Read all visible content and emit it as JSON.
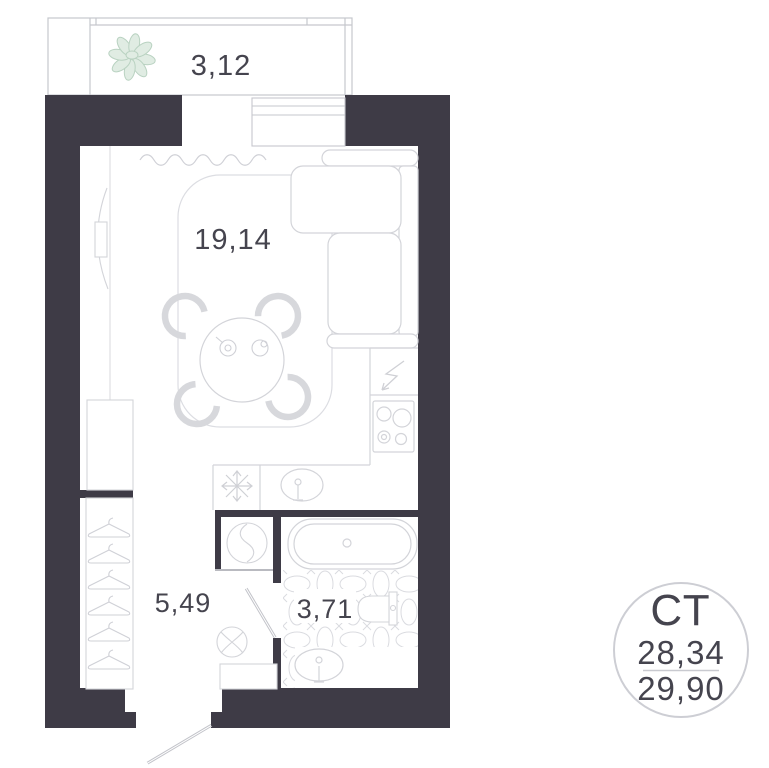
{
  "plan": {
    "areas": {
      "balcony": "3,12",
      "living": "19,14",
      "hall": "5,49",
      "bathroom": "3,71"
    },
    "badge": {
      "type_label": "СТ",
      "area_top": "28,34",
      "area_bottom": "29,90"
    },
    "colors": {
      "wall": "#3e3b46",
      "furniture_line": "#d3d4d9",
      "tile_line": "#dadbe0",
      "text": "#45444e",
      "plant_fill": "#e0ece3",
      "plant_stroke": "#b9d2c1",
      "badge_border": "#cdced4"
    }
  }
}
